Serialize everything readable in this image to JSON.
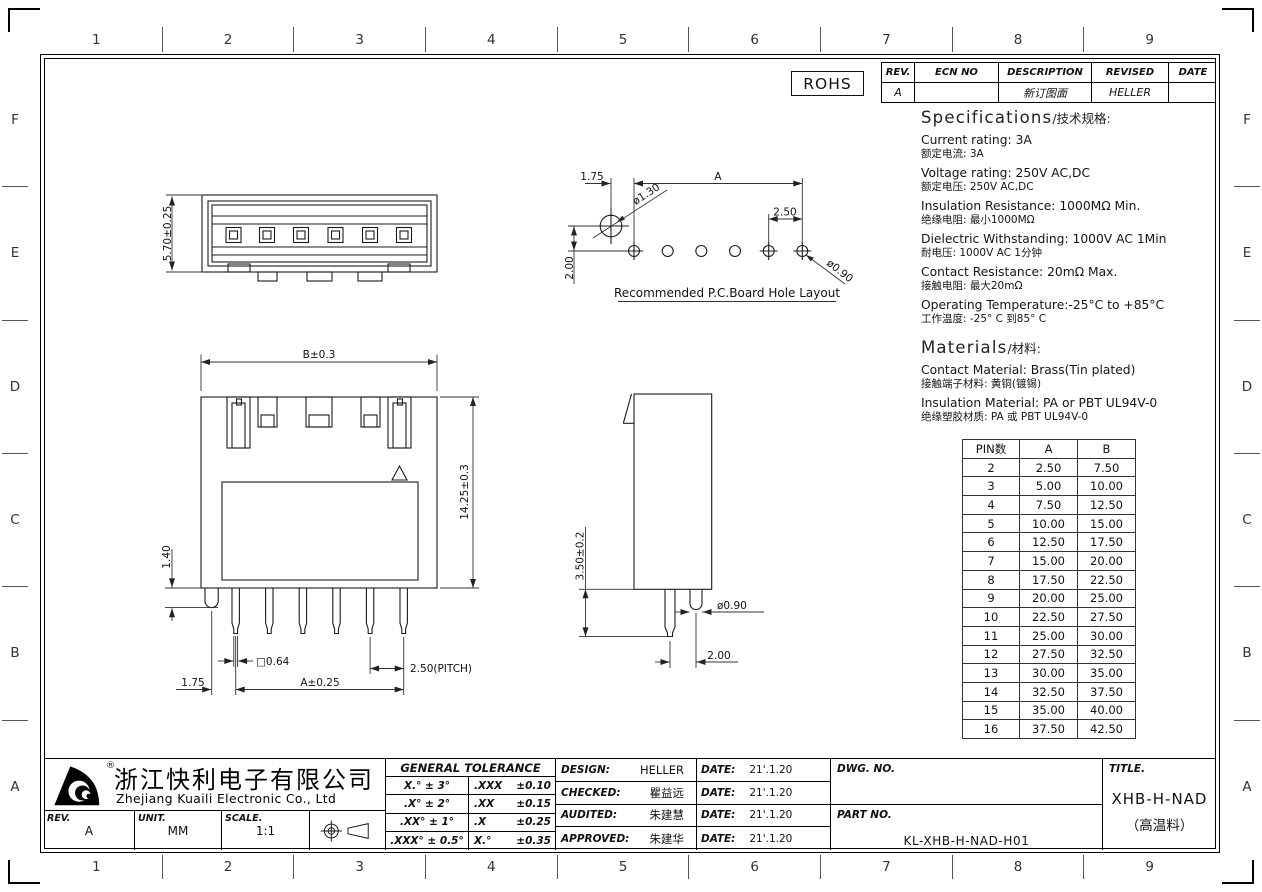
{
  "border": {
    "columns": [
      "1",
      "2",
      "3",
      "4",
      "5",
      "6",
      "7",
      "8",
      "9"
    ],
    "rows": [
      "F",
      "E",
      "D",
      "C",
      "B",
      "A"
    ]
  },
  "rohs": "ROHS",
  "revision_table": {
    "headers": [
      "REV.",
      "ECN NO",
      "DESCRIPTION",
      "REVISED",
      "DATE"
    ],
    "row": {
      "rev": "A",
      "ecn": "",
      "description": "新订图面",
      "revised": "HELLER",
      "date": ""
    }
  },
  "specifications": {
    "title": "Specifications",
    "title_suffix": "/技术规格:",
    "items": [
      {
        "en": "Current rating: 3A",
        "zh": "额定电流: 3A"
      },
      {
        "en": "Voltage rating: 250V AC,DC",
        "zh": "额定电压: 250V AC,DC"
      },
      {
        "en": "Insulation Resistance: 1000MΩ Min.",
        "zh": "绝缘电阻: 最小1000MΩ"
      },
      {
        "en": "Dielectric Withstanding: 1000V AC 1Min",
        "zh": "耐电压: 1000V AC 1分钟"
      },
      {
        "en": "Contact Resistance: 20mΩ Max.",
        "zh": "接触电阻: 最大20mΩ"
      },
      {
        "en": "Operating Temperature:-25°C to +85°C",
        "zh": "工作温度: -25° C 到85° C"
      }
    ]
  },
  "materials": {
    "title": "Materials",
    "title_suffix": "/材料:",
    "items": [
      {
        "en": "Contact Material: Brass(Tin plated)",
        "zh": "接触端子材料: 黄铜(镀锡)"
      },
      {
        "en": "Insulation Material: PA or PBT UL94V-0",
        "zh": "绝缘塑胶材质: PA 或 PBT UL94V-0"
      }
    ]
  },
  "pin_table": {
    "headers": [
      "PIN数",
      "A",
      "B"
    ],
    "rows": [
      {
        "pin": "2",
        "a": "2.50",
        "b": "7.50"
      },
      {
        "pin": "3",
        "a": "5.00",
        "b": "10.00"
      },
      {
        "pin": "4",
        "a": "7.50",
        "b": "12.50"
      },
      {
        "pin": "5",
        "a": "10.00",
        "b": "15.00"
      },
      {
        "pin": "6",
        "a": "12.50",
        "b": "17.50"
      },
      {
        "pin": "7",
        "a": "15.00",
        "b": "20.00"
      },
      {
        "pin": "8",
        "a": "17.50",
        "b": "22.50"
      },
      {
        "pin": "9",
        "a": "20.00",
        "b": "25.00"
      },
      {
        "pin": "10",
        "a": "22.50",
        "b": "27.50"
      },
      {
        "pin": "11",
        "a": "25.00",
        "b": "30.00"
      },
      {
        "pin": "12",
        "a": "27.50",
        "b": "32.50"
      },
      {
        "pin": "13",
        "a": "30.00",
        "b": "35.00"
      },
      {
        "pin": "14",
        "a": "32.50",
        "b": "37.50"
      },
      {
        "pin": "15",
        "a": "35.00",
        "b": "40.00"
      },
      {
        "pin": "16",
        "a": "37.50",
        "b": "42.50"
      }
    ]
  },
  "drawings": {
    "top_view": {
      "dim_height": "5.70±0.25"
    },
    "pcb": {
      "dim_1_75": "1.75",
      "dim_a": "A",
      "dim_d_big": "ø1.30",
      "dim_2_50": "2.50",
      "dim_2_00": "2.00",
      "dim_d_small": "ø0.90",
      "caption": "Recommended P.C.Board Hole Layout"
    },
    "front": {
      "dim_b": "B±0.3",
      "dim_h": "14.25±0.3",
      "dim_1_40": "1.40",
      "dim_sq": "□0.64",
      "dim_pitch": "2.50(PITCH)",
      "dim_1_75": "1.75",
      "dim_a": "A±0.25"
    },
    "side": {
      "dim_h": "3.50±0.2",
      "dim_d": "ø0.90",
      "dim_2_00": "2.00"
    }
  },
  "title_block": {
    "company": {
      "name_zh": "浙江快利电子有限公司",
      "name_en": "Zhejiang Kuaili Electronic Co., Ltd",
      "registered_mark": "®"
    },
    "fields": {
      "rev_label": "REV.",
      "rev": "A",
      "unit_label": "UNIT.",
      "unit": "MM",
      "scale_label": "SCALE.",
      "scale": "1:1"
    },
    "tolerance": {
      "title": "GENERAL TOLERANCE",
      "rows": [
        {
          "l": "X.° ± 3°",
          "rl": ".XXX",
          "rv": "±0.10"
        },
        {
          "l": ".X° ± 2°",
          "rl": ".XX",
          "rv": "±0.15"
        },
        {
          "l": ".XX° ± 1°",
          "rl": ".X",
          "rv": "±0.25"
        },
        {
          "l": ".XXX° ± 0.5°",
          "rl": "X.°",
          "rv": "±0.35"
        }
      ]
    },
    "signatures": [
      {
        "label": "DESIGN:",
        "name": "HELLER",
        "date_label": "DATE:",
        "date": "21'.1.20"
      },
      {
        "label": "CHECKED:",
        "name": "瞿益远",
        "date_label": "DATE:",
        "date": "21'.1.20"
      },
      {
        "label": "AUDITED:",
        "name": "朱建慧",
        "date_label": "DATE:",
        "date": "21'.1.20"
      },
      {
        "label": "APPROVED:",
        "name": "朱建华",
        "date_label": "DATE:",
        "date": "21'.1.20"
      }
    ],
    "dwg_no_label": "DWG. NO.",
    "part_no_label": "PART NO.",
    "part_no": "KL-XHB-H-NAD-H01",
    "title_label": "TITLE.",
    "product_title": "XHB-H-NAD",
    "product_subtitle": "（高温料）"
  }
}
